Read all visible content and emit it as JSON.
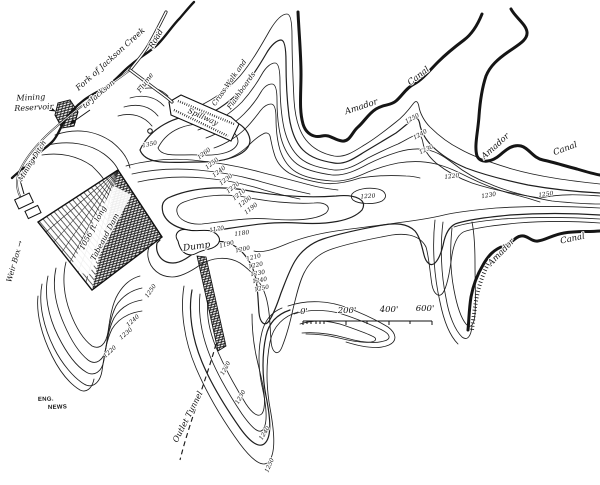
{
  "map": {
    "colors": {
      "ink": "#1b1b1b",
      "paper": "#ffffff"
    },
    "feature_labels": [
      {
        "name": "mining-reservoir-label-line1",
        "text": "Mining",
        "x": 31,
        "y": 100,
        "r": -3,
        "s": 8
      },
      {
        "name": "mining-reservoir-label-line2",
        "text": "Reservoir",
        "x": 34,
        "y": 110,
        "r": -3,
        "s": 8
      },
      {
        "name": "fork-of-jackson-creek-label",
        "text": "Fork of Jackson Creek",
        "x": 112,
        "y": 61,
        "r": -42,
        "s": 8
      },
      {
        "name": "road-label",
        "text": "Road",
        "x": 158,
        "y": 40,
        "r": -60,
        "s": 8
      },
      {
        "name": "to-jackson-label",
        "text": "to Jackson",
        "x": 100,
        "y": 96,
        "r": -40,
        "s": 7.5
      },
      {
        "name": "flume-label",
        "text": "Flume",
        "x": 147,
        "y": 84,
        "r": -54,
        "s": 7
      },
      {
        "name": "spillway-label",
        "text": "Spillway",
        "x": 202,
        "y": 119,
        "r": 24,
        "s": 7.5
      },
      {
        "name": "cross-walk-label-line1",
        "text": "Cross-Walk and",
        "x": 231,
        "y": 84,
        "r": -55,
        "s": 7
      },
      {
        "name": "cross-walk-label-line2",
        "text": "Flashboards",
        "x": 243,
        "y": 92,
        "r": -55,
        "s": 7
      },
      {
        "name": "mining-ditch-label",
        "text": "Mining Ditch",
        "x": 34,
        "y": 162,
        "r": -58,
        "s": 7
      },
      {
        "name": "weir-box-label",
        "text": "Weir Box →",
        "x": 17,
        "y": 262,
        "r": -74,
        "s": 7.5
      },
      {
        "name": "dam-label-line1",
        "text": "1056 ft. long",
        "x": 95,
        "y": 229,
        "r": -62,
        "s": 7.5
      },
      {
        "name": "dam-label-line2",
        "text": "Tabeaud Dam",
        "x": 107,
        "y": 238,
        "r": -62,
        "s": 7.5
      },
      {
        "name": "amador-canal-north-label-word1",
        "text": "Amador",
        "x": 362,
        "y": 109,
        "r": -18,
        "s": 8.5
      },
      {
        "name": "amador-canal-north-label-word2",
        "text": "Canal",
        "x": 420,
        "y": 78,
        "r": -38,
        "s": 8.5
      },
      {
        "name": "amador-canal-east-label-word1",
        "text": "Amador",
        "x": 497,
        "y": 148,
        "r": -42,
        "s": 8.5
      },
      {
        "name": "amador-canal-east-label-word2",
        "text": "Canal",
        "x": 566,
        "y": 151,
        "r": -20,
        "s": 8.5
      },
      {
        "name": "amador-canal-southeast-label-word1",
        "text": "Amador",
        "x": 503,
        "y": 254,
        "r": -46,
        "s": 8.5
      },
      {
        "name": "amador-canal-southeast-label-word2",
        "text": "Canal",
        "x": 573,
        "y": 241,
        "r": -12,
        "s": 8.5
      },
      {
        "name": "dump-label",
        "text": "Dump",
        "x": 197,
        "y": 249,
        "r": -8,
        "s": 9
      },
      {
        "name": "outlet-tunnel-label",
        "text": "Outlet Tunnel",
        "x": 190,
        "y": 418,
        "r": -63,
        "s": 8
      }
    ],
    "contour_labels": [
      {
        "v": "1350",
        "x": 150,
        "y": 146,
        "r": -12
      },
      {
        "v": "1260",
        "x": 205,
        "y": 155,
        "r": -38
      },
      {
        "v": "1250",
        "x": 213,
        "y": 165,
        "r": -38
      },
      {
        "v": "1240",
        "x": 220,
        "y": 173,
        "r": -38
      },
      {
        "v": "1230",
        "x": 227,
        "y": 181,
        "r": -38
      },
      {
        "v": "1220",
        "x": 234,
        "y": 189,
        "r": -38
      },
      {
        "v": "1210",
        "x": 240,
        "y": 196,
        "r": -38
      },
      {
        "v": "1200",
        "x": 246,
        "y": 203,
        "r": -38
      },
      {
        "v": "1190",
        "x": 252,
        "y": 210,
        "r": -38
      },
      {
        "v": "1170",
        "x": 217,
        "y": 231,
        "r": -10
      },
      {
        "v": "1180",
        "x": 242,
        "y": 235,
        "r": -8
      },
      {
        "v": "1190",
        "x": 227,
        "y": 246,
        "r": -14
      },
      {
        "v": "1200",
        "x": 243,
        "y": 251,
        "r": -12
      },
      {
        "v": "1210",
        "x": 254,
        "y": 259,
        "r": -14
      },
      {
        "v": "1220",
        "x": 256,
        "y": 267,
        "r": -12
      },
      {
        "v": "1230",
        "x": 258,
        "y": 275,
        "r": -10
      },
      {
        "v": "1240",
        "x": 260,
        "y": 282,
        "r": -10
      },
      {
        "v": "1250",
        "x": 262,
        "y": 290,
        "r": -12
      },
      {
        "v": "1220",
        "x": 368,
        "y": 198,
        "r": -4
      },
      {
        "v": "1250",
        "x": 413,
        "y": 120,
        "r": -28
      },
      {
        "v": "1240",
        "x": 421,
        "y": 136,
        "r": -30
      },
      {
        "v": "1230",
        "x": 427,
        "y": 151,
        "r": -26
      },
      {
        "v": "1220",
        "x": 452,
        "y": 178,
        "r": -8
      },
      {
        "v": "1230",
        "x": 489,
        "y": 197,
        "r": -10
      },
      {
        "v": "1250",
        "x": 546,
        "y": 196,
        "r": -8
      },
      {
        "v": "1220",
        "x": 227,
        "y": 369,
        "r": -62
      },
      {
        "v": "1230",
        "x": 242,
        "y": 398,
        "r": -60
      },
      {
        "v": "1240",
        "x": 266,
        "y": 434,
        "r": -58
      },
      {
        "v": "1250",
        "x": 271,
        "y": 466,
        "r": -66
      },
      {
        "v": "1250",
        "x": 152,
        "y": 292,
        "r": -55
      },
      {
        "v": "1240",
        "x": 134,
        "y": 322,
        "r": -42
      },
      {
        "v": "1230",
        "x": 127,
        "y": 335,
        "r": -40
      },
      {
        "v": "1220",
        "x": 111,
        "y": 353,
        "r": -42
      }
    ],
    "scale_bar": {
      "labels": [
        "0'",
        "200'",
        "400'",
        "600'"
      ]
    },
    "credit": {
      "line1": "ENG.",
      "line2": "NEWS"
    }
  }
}
